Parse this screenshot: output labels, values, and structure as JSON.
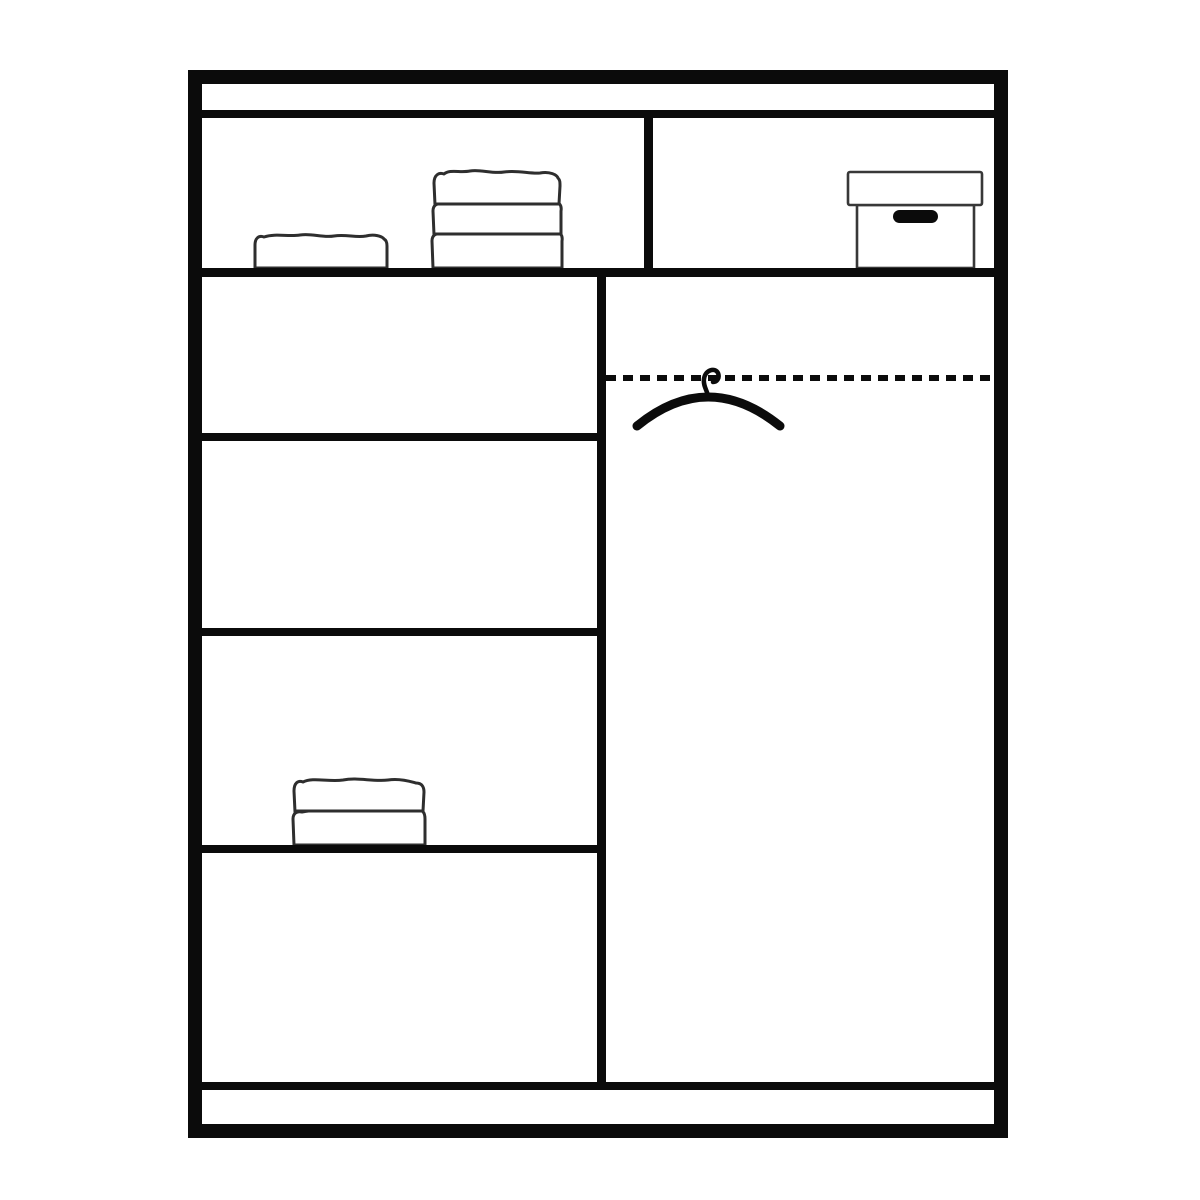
{
  "colors": {
    "background": "#ffffff",
    "line": "#0b0b0b",
    "item_outline": "#2e2e2e"
  },
  "diagram": {
    "kind": "wardrobe-interior-schematic",
    "style": "black line drawing on white, no text labels",
    "frame": "thick black rectangular outer border with thin top strip and bottom plinth strip",
    "top_shelf": {
      "left_compartment": {
        "items": [
          {
            "name": "folded-towel",
            "layers": 1
          },
          {
            "name": "folded-towel-stack",
            "layers": 3
          }
        ]
      },
      "right_compartment": {
        "items": [
          {
            "name": "storage-box",
            "features": [
              "lid",
              "black-handle-slot"
            ]
          }
        ]
      }
    },
    "left_column": {
      "compartments": 4,
      "items": [
        {
          "name": "folded-towel-stack",
          "layers": 2,
          "compartment_index": 3
        }
      ]
    },
    "right_column": {
      "items": [
        {
          "name": "hanging-rail",
          "style": "dashed-line"
        },
        {
          "name": "clothes-hanger",
          "position": "hooked-near-left-of-rail"
        }
      ]
    }
  }
}
